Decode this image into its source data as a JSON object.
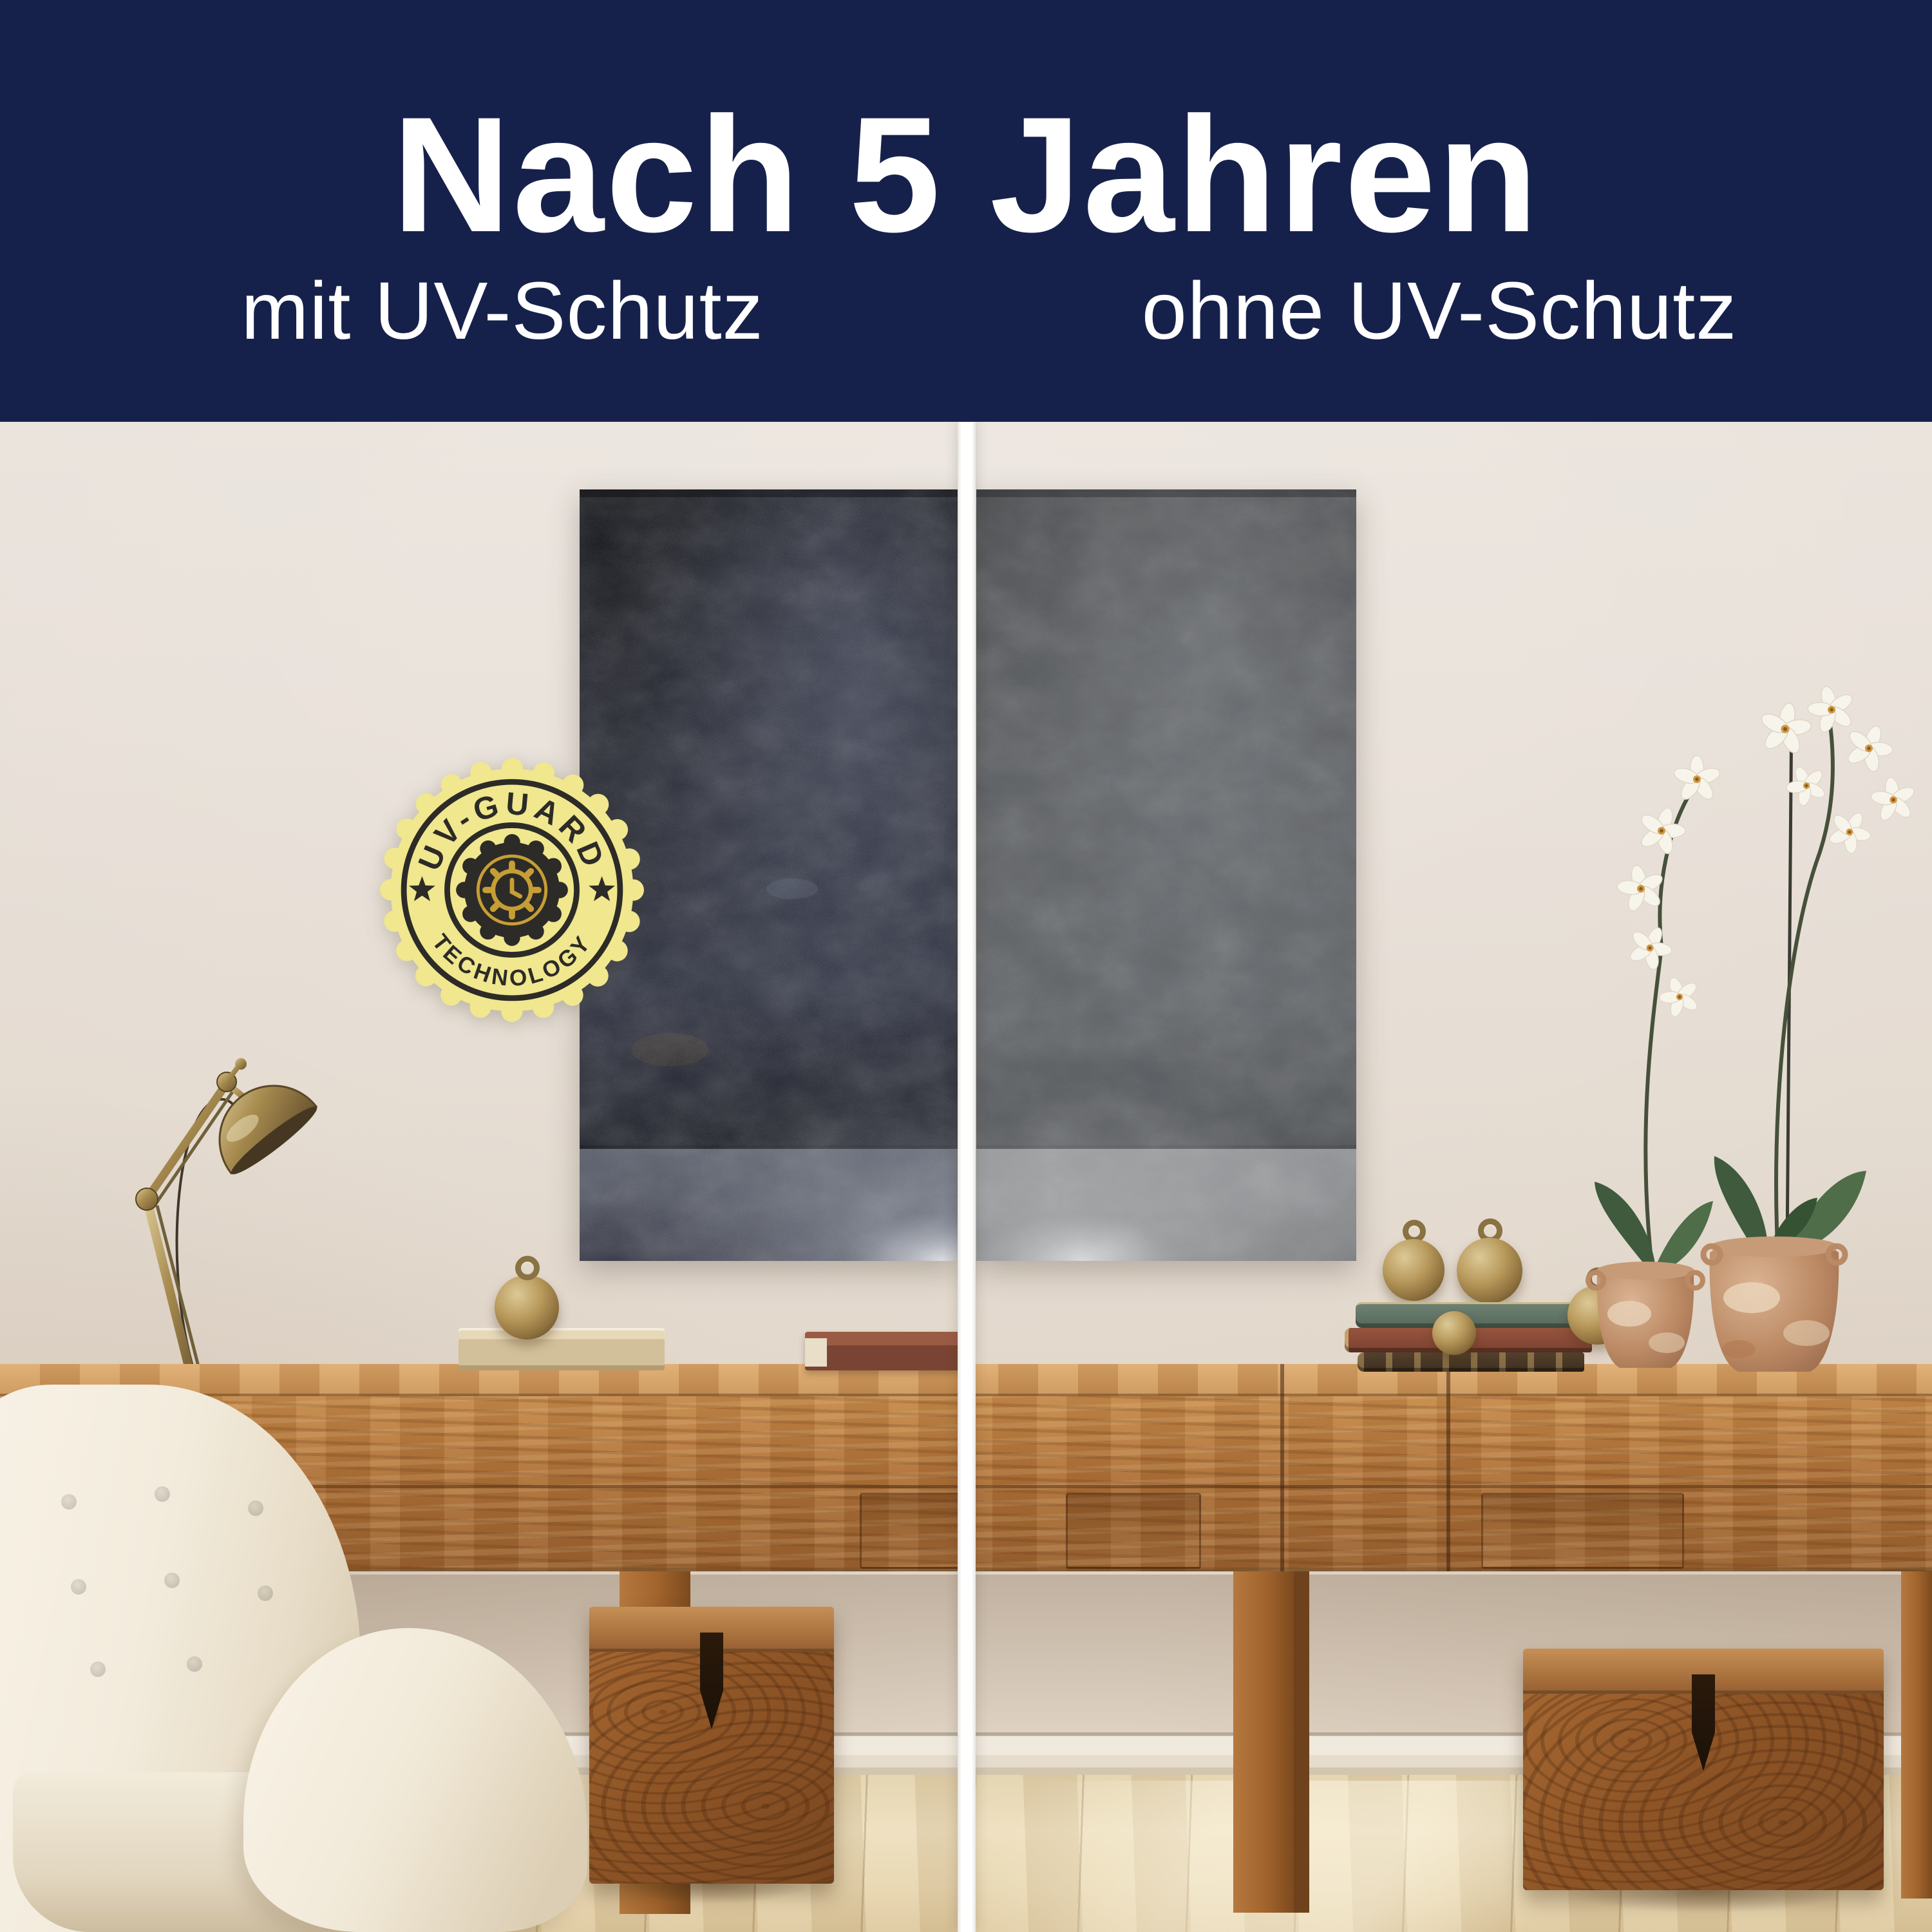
{
  "header": {
    "title": "Nach 5 Jahren",
    "left_label": "mit UV-Schutz",
    "right_label": "ohne UV-Schutz",
    "background_color": "#16214b",
    "text_color": "#ffffff"
  },
  "badge": {
    "top_text": "UV-GUARD",
    "bottom_text": "TECHNOLOGY",
    "fill_color": "#f0e78e",
    "ink_color": "#2d2b27",
    "gold_color": "#c59e35"
  },
  "comparison": {
    "divider_color": "#ffffff",
    "panels": [
      {
        "label": "mit UV-Schutz",
        "poster_tone": "#23252f"
      },
      {
        "label": "ohne UV-Schutz",
        "poster_tone": "#55575a"
      }
    ]
  },
  "scene": {
    "wall_color": "#e6ddd3",
    "floor_color": "#e7d5ae",
    "wood_color": "#ae7138",
    "chair_color": "#f3ecdd",
    "brass_color": "#a68a4e"
  }
}
